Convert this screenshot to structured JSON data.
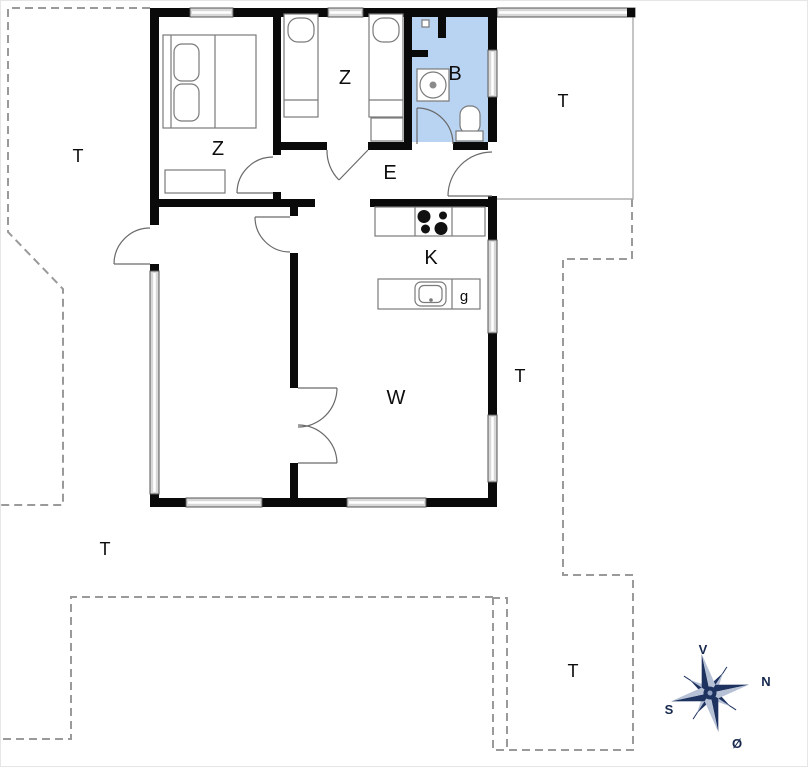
{
  "rooms": {
    "bedroom_large": "Z",
    "bedroom_small": "Z",
    "bathroom": "B",
    "entrance": "E",
    "kitchen": "K",
    "living_room": "W",
    "appliance": "g"
  },
  "terraces": {
    "west": "T",
    "northeast": "T",
    "east": "T",
    "southwest": "T",
    "southeast": "T"
  },
  "compass": {
    "top": "V",
    "right": "N",
    "left": "S",
    "bottom": "Ø"
  },
  "colors": {
    "bathroom_fill": "#b9d3f2",
    "wall": "#0a0a0a",
    "window_fill": "#d8d8d8",
    "terrace_line": "#9a9a9a",
    "compass_dark": "#1e3260",
    "compass_light": "#b6c1d6"
  }
}
